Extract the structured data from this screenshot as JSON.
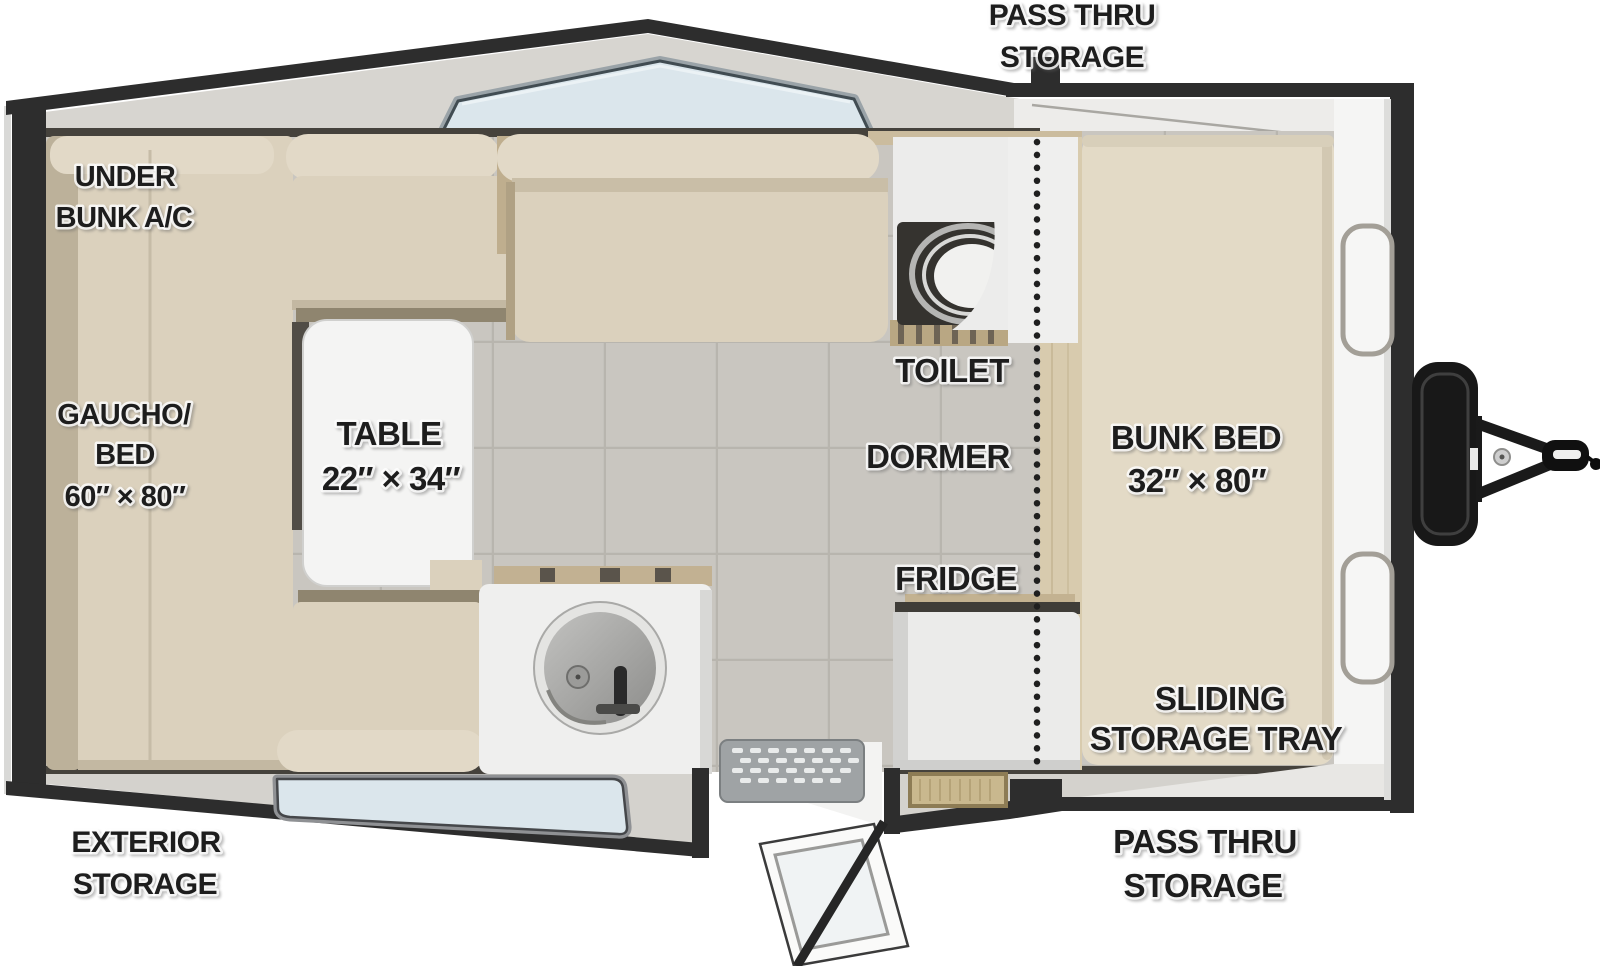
{
  "title": "A-frame camper travel trailer floorplan (top view)",
  "labels": {
    "pass_thru_storage_top": {
      "line1": "PASS THRU",
      "line2": "STORAGE"
    },
    "under_bunk_ac": {
      "line1": "UNDER",
      "line2": "BUNK A/C"
    },
    "gaucho_bed": {
      "line1": "GAUCHO/",
      "line2": "BED",
      "line3": "60″ × 80″"
    },
    "table": {
      "line1": "TABLE",
      "line2": "22″ × 34″"
    },
    "toilet": {
      "line1": "TOILET"
    },
    "dormer": {
      "line1": "DORMER"
    },
    "fridge": {
      "line1": "FRIDGE"
    },
    "bunk_bed": {
      "line1": "BUNK BED",
      "line2": "32″ × 80″"
    },
    "sliding_storage_tray": {
      "line1": "SLIDING",
      "line2": "STORAGE TRAY"
    },
    "exterior_storage": {
      "line1": "EXTERIOR",
      "line2": "STORAGE"
    },
    "pass_thru_storage_bottom": {
      "line1": "PASS THRU",
      "line2": "STORAGE"
    }
  },
  "colors": {
    "outline": "#2d2d2d",
    "roof_panel": "#d7d5d0",
    "cushion": "#dbd1bd",
    "cushion_light": "#e2d9c7",
    "cushion_shadow": "#bcb19a",
    "bunk_cushion": "#e3dac6",
    "wood": "#c2b192",
    "wood_dark": "#8f856f",
    "white_surface": "#efefee",
    "tile_floor": "#c9c6c0",
    "glass": "#dbe6ec",
    "text": "#1d1d1d",
    "background": "#ffffff"
  }
}
